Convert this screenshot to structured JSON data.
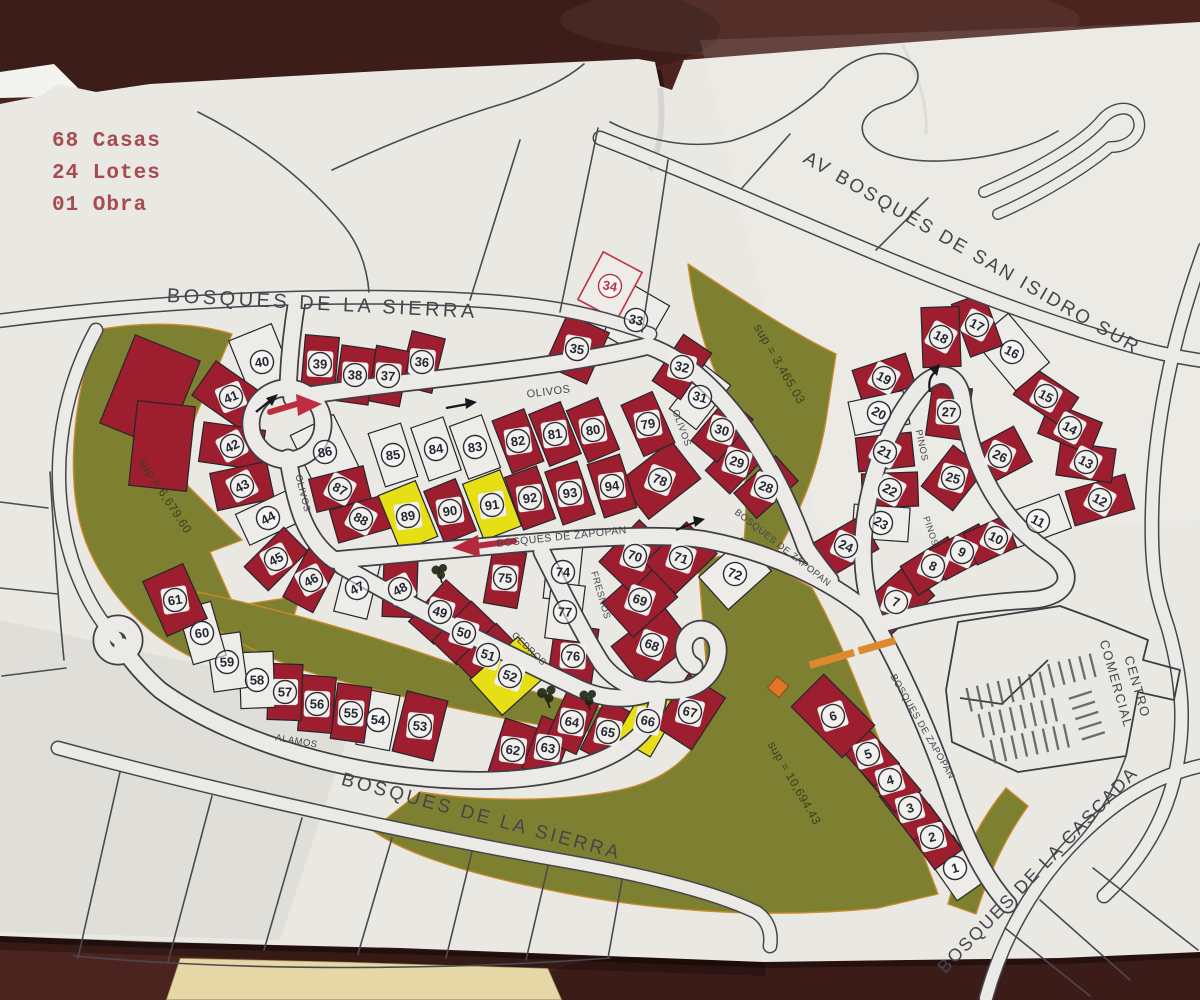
{
  "legend": {
    "items": [
      "68 Casas",
      "24 Lotes",
      "01 Obra"
    ],
    "color": "#a84a52"
  },
  "colors": {
    "paper": "#e9e8e3",
    "desk": "#4b241f",
    "lot_red": "#9c1e2f",
    "lot_white": "#edece8",
    "lot_yellow": "#e6df16",
    "green_area": "#7c8030",
    "green_edge": "#c98a2c",
    "road_line": "#3f3f45",
    "street_text": "#45454c",
    "sup_text": "#3a3f20",
    "annotation_red": "#bf2b3f",
    "orange": "#dd8a2e"
  },
  "map_texts": [
    {
      "name": "street-bosques-de-la-sierra-top",
      "t": "BOSQUES DE LA SIERRA",
      "x": 322,
      "y": 310,
      "r": 3,
      "s": 20,
      "ls": 3.5
    },
    {
      "name": "street-av-bosques-de-san-isidro-sur",
      "t": "AV BOSQUES DE SAN ISIDRO SUR",
      "x": 969,
      "y": 258,
      "r": 30,
      "s": 19,
      "ls": 2.5
    },
    {
      "name": "street-bosques-de-la-sierra-bottom",
      "t": "BOSQUES DE LA SIERRA",
      "x": 480,
      "y": 822,
      "r": 15,
      "s": 19,
      "ls": 3
    },
    {
      "name": "street-bosques-de-la-cascada",
      "t": "BOSQUES DE LA CASCADA",
      "x": 1042,
      "y": 874,
      "r": -46,
      "s": 18,
      "ls": 2
    },
    {
      "name": "label-centro",
      "t": "CENTRO",
      "x": 1133,
      "y": 688,
      "r": 74,
      "s": 13,
      "ls": 1.5
    },
    {
      "name": "label-comercial",
      "t": "COMERCIAL",
      "x": 1112,
      "y": 685,
      "r": 74,
      "s": 13,
      "ls": 1.5
    },
    {
      "name": "street-olivos-main",
      "t": "OLIVOS",
      "x": 549,
      "y": 395,
      "r": -7,
      "s": 11
    },
    {
      "name": "street-olivos-diag",
      "t": "OLIVOS",
      "x": 679,
      "y": 429,
      "r": 70,
      "s": 9.5
    },
    {
      "name": "street-olivos-vert",
      "t": "OLIVOS",
      "x": 300,
      "y": 494,
      "r": 76,
      "s": 9.5
    },
    {
      "name": "street-pinos-upper",
      "t": "PINOS",
      "x": 919,
      "y": 446,
      "r": 78,
      "s": 9.5
    },
    {
      "name": "street-pinos-lower",
      "t": "PINOS",
      "x": 928,
      "y": 532,
      "r": 72,
      "s": 9
    },
    {
      "name": "street-bosques-de-zapopan-mid",
      "t": "BOSQUES DE ZAPOPAN",
      "x": 562,
      "y": 540,
      "r": -6,
      "s": 10.5
    },
    {
      "name": "street-bosques-de-zapopan-diag",
      "t": "BOSQUES DE ZAPOPAN",
      "x": 781,
      "y": 550,
      "r": 38,
      "s": 9.5
    },
    {
      "name": "street-bosques-de-zapopan-south",
      "t": "BOSQUES DE ZAPOPAN",
      "x": 920,
      "y": 728,
      "r": 60,
      "s": 9.5
    },
    {
      "name": "street-fresnos",
      "t": "FRESNOS",
      "x": 598,
      "y": 596,
      "r": 74,
      "s": 9.5
    },
    {
      "name": "street-cedros",
      "t": "CEDROS",
      "x": 527,
      "y": 651,
      "r": 44,
      "s": 9.5
    },
    {
      "name": "street-alamos",
      "t": "ALAMOS",
      "x": 296,
      "y": 744,
      "r": 10,
      "s": 9.5
    },
    {
      "name": "area-sup-3465",
      "t": "sup = 3,465.03",
      "x": 776,
      "y": 366,
      "r": 60,
      "s": 12.5,
      "c": "#3a3f20"
    },
    {
      "name": "area-sup-6679",
      "t": "sup = 6,679.60",
      "x": 162,
      "y": 498,
      "r": 57,
      "s": 12,
      "c": "#3a3f20"
    },
    {
      "name": "area-sup-10694",
      "t": "sup = 10,694.43",
      "x": 791,
      "y": 785,
      "r": 60,
      "s": 12,
      "c": "#3a3f20"
    }
  ],
  "lots": [
    {
      "n": "",
      "x": 150,
      "y": 392,
      "r": -68,
      "w": 95,
      "h": 70,
      "c": "r"
    },
    {
      "n": "",
      "x": 162,
      "y": 446,
      "r": -84,
      "w": 85,
      "h": 58,
      "c": "r"
    },
    {
      "n": 1,
      "x": 955,
      "y": 868,
      "r": -35,
      "c": "w"
    },
    {
      "n": 2,
      "x": 932,
      "y": 837,
      "r": -36,
      "c": "r"
    },
    {
      "n": 3,
      "x": 910,
      "y": 808,
      "r": -38,
      "c": "r"
    },
    {
      "n": 4,
      "x": 890,
      "y": 780,
      "r": -40,
      "c": "r"
    },
    {
      "n": 5,
      "x": 868,
      "y": 754,
      "r": -42,
      "c": "r"
    },
    {
      "n": 6,
      "x": 833,
      "y": 716,
      "r": -45,
      "w": 46,
      "h": 72,
      "c": "r"
    },
    {
      "n": 7,
      "x": 896,
      "y": 602,
      "r": 48,
      "w": 42,
      "h": 66,
      "c": "r"
    },
    {
      "n": 8,
      "x": 933,
      "y": 566,
      "r": 58,
      "c": "r"
    },
    {
      "n": 9,
      "x": 962,
      "y": 552,
      "r": 62,
      "c": "r"
    },
    {
      "n": 10,
      "x": 996,
      "y": 538,
      "r": 66,
      "c": "r"
    },
    {
      "n": 11,
      "x": 1038,
      "y": 521,
      "r": 70,
      "w": 36,
      "h": 58,
      "c": "w"
    },
    {
      "n": 12,
      "x": 1100,
      "y": 500,
      "r": 74,
      "w": 36,
      "h": 62,
      "c": "r"
    },
    {
      "n": 13,
      "x": 1086,
      "y": 462,
      "r": 98,
      "c": "r"
    },
    {
      "n": 14,
      "x": 1070,
      "y": 428,
      "r": 112,
      "c": "r"
    },
    {
      "n": 15,
      "x": 1046,
      "y": 396,
      "r": 124,
      "c": "r"
    },
    {
      "n": 16,
      "x": 1012,
      "y": 352,
      "r": 140,
      "w": 44,
      "h": 64,
      "c": "w"
    },
    {
      "n": 17,
      "x": 977,
      "y": 325,
      "r": 160,
      "c": "r"
    },
    {
      "n": 18,
      "x": 941,
      "y": 337,
      "r": 178,
      "w": 38,
      "h": 60,
      "c": "r"
    },
    {
      "n": 19,
      "x": 884,
      "y": 378,
      "r": 72,
      "c": "r"
    },
    {
      "n": 20,
      "x": 879,
      "y": 413,
      "r": 78,
      "c": "w"
    },
    {
      "n": 21,
      "x": 885,
      "y": 452,
      "r": 84,
      "c": "r"
    },
    {
      "n": 22,
      "x": 890,
      "y": 490,
      "r": 88,
      "c": "r"
    },
    {
      "n": 23,
      "x": 881,
      "y": 523,
      "r": 94,
      "c": "w"
    },
    {
      "n": 24,
      "x": 846,
      "y": 546,
      "r": 60,
      "w": 38,
      "h": 54,
      "c": "r"
    },
    {
      "n": 25,
      "x": 953,
      "y": 478,
      "r": 38,
      "w": 40,
      "h": 52,
      "c": "r"
    },
    {
      "n": 26,
      "x": 1000,
      "y": 456,
      "r": 62,
      "w": 40,
      "h": 52,
      "c": "r"
    },
    {
      "n": 27,
      "x": 949,
      "y": 412,
      "r": 8,
      "w": 40,
      "h": 52,
      "c": "r"
    },
    {
      "n": 28,
      "x": 766,
      "y": 487,
      "r": 48,
      "c": "r"
    },
    {
      "n": 29,
      "x": 737,
      "y": 462,
      "r": 44,
      "c": "r"
    },
    {
      "n": 30,
      "x": 722,
      "y": 430,
      "r": 40,
      "c": "r"
    },
    {
      "n": 31,
      "x": 700,
      "y": 397,
      "r": 38,
      "c": "w"
    },
    {
      "n": 32,
      "x": 682,
      "y": 367,
      "r": 34,
      "c": "r"
    },
    {
      "n": 33,
      "x": 636,
      "y": 320,
      "r": 30,
      "w": 44,
      "h": 58,
      "c": "w"
    },
    {
      "n": 34,
      "x": 610,
      "y": 286,
      "r": 28,
      "w": 44,
      "h": 54,
      "c": "o"
    },
    {
      "n": 35,
      "x": 577,
      "y": 349,
      "r": 24,
      "w": 46,
      "h": 56,
      "c": "r"
    },
    {
      "n": 36,
      "x": 422,
      "y": 362,
      "r": 14,
      "c": "r"
    },
    {
      "n": 37,
      "x": 388,
      "y": 376,
      "r": 11,
      "c": "r"
    },
    {
      "n": 38,
      "x": 355,
      "y": 375,
      "r": 8,
      "c": "r"
    },
    {
      "n": 39,
      "x": 320,
      "y": 364,
      "r": 5,
      "c": "r"
    },
    {
      "n": 40,
      "x": 262,
      "y": 362,
      "r": -22,
      "w": 46,
      "h": 64,
      "c": "w"
    },
    {
      "n": 41,
      "x": 231,
      "y": 397,
      "r": -55,
      "w": 42,
      "h": 66,
      "c": "r"
    },
    {
      "n": 42,
      "x": 232,
      "y": 446,
      "r": -82,
      "w": 40,
      "h": 62,
      "c": "r"
    },
    {
      "n": 43,
      "x": 242,
      "y": 486,
      "r": -102,
      "w": 38,
      "h": 58,
      "c": "r"
    },
    {
      "n": 44,
      "x": 268,
      "y": 518,
      "r": -115,
      "c": "w"
    },
    {
      "n": 45,
      "x": 276,
      "y": 559,
      "r": -135,
      "c": "r"
    },
    {
      "n": 46,
      "x": 311,
      "y": 580,
      "r": -152,
      "c": "r"
    },
    {
      "n": 47,
      "x": 357,
      "y": 588,
      "r": -166,
      "c": "w"
    },
    {
      "n": 48,
      "x": 400,
      "y": 589,
      "r": -178,
      "c": "r"
    },
    {
      "n": 49,
      "x": 440,
      "y": 612,
      "r": 42,
      "c": "r"
    },
    {
      "n": 50,
      "x": 464,
      "y": 633,
      "r": 44,
      "c": "r"
    },
    {
      "n": 51,
      "x": 488,
      "y": 655,
      "r": 46,
      "c": "r"
    },
    {
      "n": 52,
      "x": 510,
      "y": 676,
      "r": 48,
      "w": 48,
      "h": 64,
      "c": "y"
    },
    {
      "n": 53,
      "x": 420,
      "y": 726,
      "r": 14,
      "w": 42,
      "h": 62,
      "c": "r"
    },
    {
      "n": 54,
      "x": 378,
      "y": 720,
      "r": 11,
      "c": "w"
    },
    {
      "n": 55,
      "x": 351,
      "y": 713,
      "r": 8,
      "c": "r"
    },
    {
      "n": 56,
      "x": 317,
      "y": 704,
      "r": 5,
      "c": "r"
    },
    {
      "n": 57,
      "x": 285,
      "y": 692,
      "r": 2,
      "c": "r"
    },
    {
      "n": 58,
      "x": 257,
      "y": 680,
      "r": -2,
      "c": "w"
    },
    {
      "n": 59,
      "x": 227,
      "y": 662,
      "r": -8,
      "c": "w"
    },
    {
      "n": 60,
      "x": 202,
      "y": 633,
      "r": -16,
      "c": "w"
    },
    {
      "n": 61,
      "x": 175,
      "y": 600,
      "r": -24,
      "w": 44,
      "h": 60,
      "c": "r"
    },
    {
      "n": 62,
      "x": 513,
      "y": 750,
      "r": 18,
      "c": "r"
    },
    {
      "n": 63,
      "x": 548,
      "y": 748,
      "r": 21,
      "c": "r"
    },
    {
      "n": 64,
      "x": 572,
      "y": 722,
      "r": 24,
      "c": "r"
    },
    {
      "n": 65,
      "x": 608,
      "y": 732,
      "r": 27,
      "c": "r"
    },
    {
      "n": 66,
      "x": 648,
      "y": 721,
      "r": 30,
      "w": 40,
      "h": 60,
      "c": "y"
    },
    {
      "n": 67,
      "x": 690,
      "y": 712,
      "r": 33,
      "w": 44,
      "h": 62,
      "c": "r"
    },
    {
      "n": 68,
      "x": 652,
      "y": 645,
      "r": 52,
      "w": 48,
      "h": 66,
      "c": "r"
    },
    {
      "n": 69,
      "x": 640,
      "y": 600,
      "r": 48,
      "w": 46,
      "h": 60,
      "c": "r"
    },
    {
      "n": 70,
      "x": 635,
      "y": 556,
      "r": 44,
      "w": 44,
      "h": 58,
      "c": "r"
    },
    {
      "n": 71,
      "x": 681,
      "y": 558,
      "r": 46,
      "w": 44,
      "h": 58,
      "c": "r"
    },
    {
      "n": 72,
      "x": 735,
      "y": 574,
      "r": 48,
      "w": 44,
      "h": 58,
      "c": "w"
    },
    {
      "n": 74,
      "x": 563,
      "y": 572,
      "r": 6,
      "c": "w"
    },
    {
      "n": 75,
      "x": 505,
      "y": 578,
      "r": 10,
      "c": "r"
    },
    {
      "n": 76,
      "x": 573,
      "y": 656,
      "r": 8,
      "w": 44,
      "h": 60,
      "c": "r"
    },
    {
      "n": 77,
      "x": 565,
      "y": 612,
      "r": 7,
      "c": "w"
    },
    {
      "n": 78,
      "x": 660,
      "y": 480,
      "r": 52,
      "w": 48,
      "h": 66,
      "c": "r"
    },
    {
      "n": 79,
      "x": 648,
      "y": 424,
      "r": -24,
      "c": "r"
    },
    {
      "n": 80,
      "x": 593,
      "y": 430,
      "r": -23,
      "c": "r"
    },
    {
      "n": 81,
      "x": 555,
      "y": 434,
      "r": -22,
      "c": "r"
    },
    {
      "n": 82,
      "x": 518,
      "y": 441,
      "r": -21,
      "c": "r"
    },
    {
      "n": 83,
      "x": 475,
      "y": 447,
      "r": -20,
      "c": "w"
    },
    {
      "n": 84,
      "x": 436,
      "y": 449,
      "r": -19,
      "c": "w"
    },
    {
      "n": 85,
      "x": 393,
      "y": 455,
      "r": -18,
      "c": "w"
    },
    {
      "n": 86,
      "x": 325,
      "y": 452,
      "r": -26,
      "w": 48,
      "h": 60,
      "c": "w"
    },
    {
      "n": 87,
      "x": 340,
      "y": 489,
      "r": 76,
      "c": "r"
    },
    {
      "n": 88,
      "x": 361,
      "y": 519,
      "r": 74,
      "c": "r"
    },
    {
      "n": 89,
      "x": 408,
      "y": 516,
      "r": -22,
      "w": 40,
      "h": 60,
      "c": "y"
    },
    {
      "n": 90,
      "x": 450,
      "y": 511,
      "r": -22,
      "c": "r"
    },
    {
      "n": 91,
      "x": 492,
      "y": 505,
      "r": -21,
      "w": 40,
      "h": 60,
      "c": "y"
    },
    {
      "n": 92,
      "x": 530,
      "y": 498,
      "r": -20,
      "c": "r"
    },
    {
      "n": 93,
      "x": 570,
      "y": 493,
      "r": -19,
      "c": "r"
    },
    {
      "n": 94,
      "x": 612,
      "y": 486,
      "r": -18,
      "c": "r"
    }
  ]
}
